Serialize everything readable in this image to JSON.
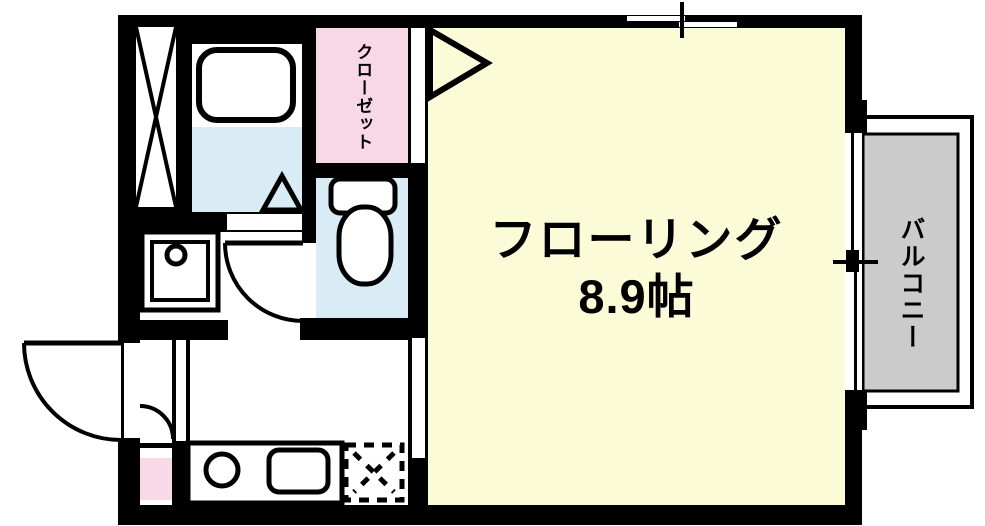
{
  "floorplan": {
    "main_room": {
      "label": "フローリング",
      "area": "8.9帖"
    },
    "closet": {
      "label": "クローゼット"
    },
    "balcony": {
      "label": "バルコニー"
    }
  },
  "colors": {
    "wall": "#000000",
    "flooring": "#FBFBD8",
    "closet": "#F8D7E6",
    "wet_area": "#D9EBF4",
    "genkan": "#F9D9E8",
    "balcony": "#CBCBCB",
    "fixture_fill": "#FFFFFF"
  }
}
